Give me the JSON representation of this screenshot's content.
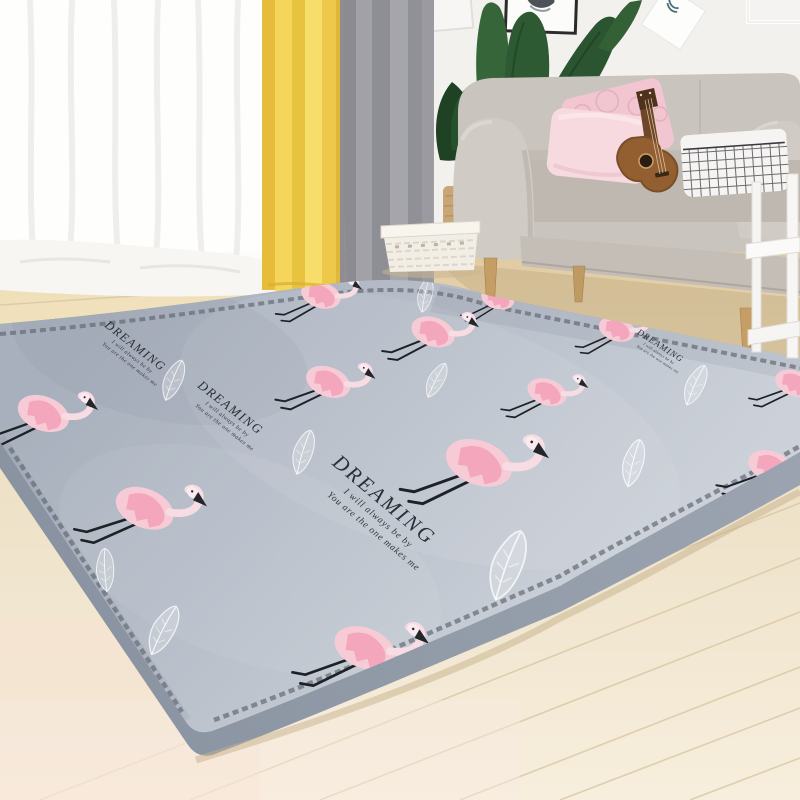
{
  "meta": {
    "alt": "Product photo: gray flamingo-print plush tatami mat rug in a living room with beige loveseat, pink pillows, ukulele, plant, yellow and gray curtains, light wood floor"
  },
  "rug": {
    "text": {
      "title": "DREAMING",
      "line1": "I will always be by",
      "line2": "You are the one makes me"
    },
    "colors": {
      "surface": "#b6bdc8",
      "side": "#929ba8",
      "trim": "#646b76",
      "flamingo_body": "#f7cbd6",
      "flamingo_wing": "#f2a3ba",
      "flamingo_neck": "#f8dce3",
      "legs_beak": "#1e2126",
      "feather": "#ffffff"
    },
    "flamingos": [
      {
        "x": 320,
        "y": 297,
        "s": 0.72,
        "r": 26
      },
      {
        "x": 497,
        "y": 300,
        "s": 0.6,
        "r": 24
      },
      {
        "x": 432,
        "y": 334,
        "s": 0.8,
        "r": 28
      },
      {
        "x": 616,
        "y": 331,
        "s": 0.66,
        "r": 26
      },
      {
        "x": 793,
        "y": 385,
        "s": 0.7,
        "r": 30
      },
      {
        "x": 546,
        "y": 394,
        "s": 0.72,
        "r": 28
      },
      {
        "x": 327,
        "y": 384,
        "s": 0.82,
        "r": 30
      },
      {
        "x": 477,
        "y": 466,
        "s": 1.22,
        "r": 30
      },
      {
        "x": 42,
        "y": 416,
        "s": 0.95,
        "r": 30
      },
      {
        "x": 143,
        "y": 511,
        "s": 1.08,
        "r": 32
      },
      {
        "x": 770,
        "y": 469,
        "s": 0.85,
        "r": 30
      },
      {
        "x": 363,
        "y": 651,
        "s": 1.12,
        "r": 30
      }
    ],
    "feathers": [
      {
        "x": 173,
        "y": 380,
        "s": 0.8,
        "r": 20
      },
      {
        "x": 303,
        "y": 452,
        "s": 0.85,
        "r": 15
      },
      {
        "x": 425,
        "y": 295,
        "s": 0.65,
        "r": 10
      },
      {
        "x": 436,
        "y": 380,
        "s": 0.7,
        "r": 25
      },
      {
        "x": 507,
        "y": 565,
        "s": 1.35,
        "r": 18
      },
      {
        "x": 695,
        "y": 385,
        "s": 0.8,
        "r": 22
      },
      {
        "x": 633,
        "y": 463,
        "s": 0.9,
        "r": 12
      },
      {
        "x": 163,
        "y": 630,
        "s": 1.0,
        "r": 25
      },
      {
        "x": 105,
        "y": 570,
        "s": 0.8,
        "r": -5
      },
      {
        "x": 567,
        "y": 290,
        "s": 0.6,
        "r": 15
      }
    ],
    "text_blocks": [
      {
        "x": 133,
        "y": 349,
        "s": 0.58,
        "r": 38
      },
      {
        "x": 228,
        "y": 411,
        "s": 0.62,
        "r": 38
      },
      {
        "x": 380,
        "y": 505,
        "s": 1.0,
        "r": 40
      },
      {
        "x": 659,
        "y": 348,
        "s": 0.42,
        "r": 33
      }
    ]
  },
  "palette": {
    "wall": "#f1efec",
    "sheer_curtain": "#fcfcfa",
    "curtain_yellow": "#f1cd4d",
    "curtain_gray": "#97979d",
    "floor": "#eee0c6",
    "sofa": "#cbc6bf",
    "pillow_pink": "#f7d9e0",
    "pillow_pattern_pink": "#f1c6d0",
    "grid_pillow": "#f5f4f2",
    "plant_green": "#2e5a33",
    "wood_leg": "#c59e66",
    "ukulele_wood": "#935f31",
    "basket": "#f2eee6",
    "side_table": "#f6f5f3"
  }
}
